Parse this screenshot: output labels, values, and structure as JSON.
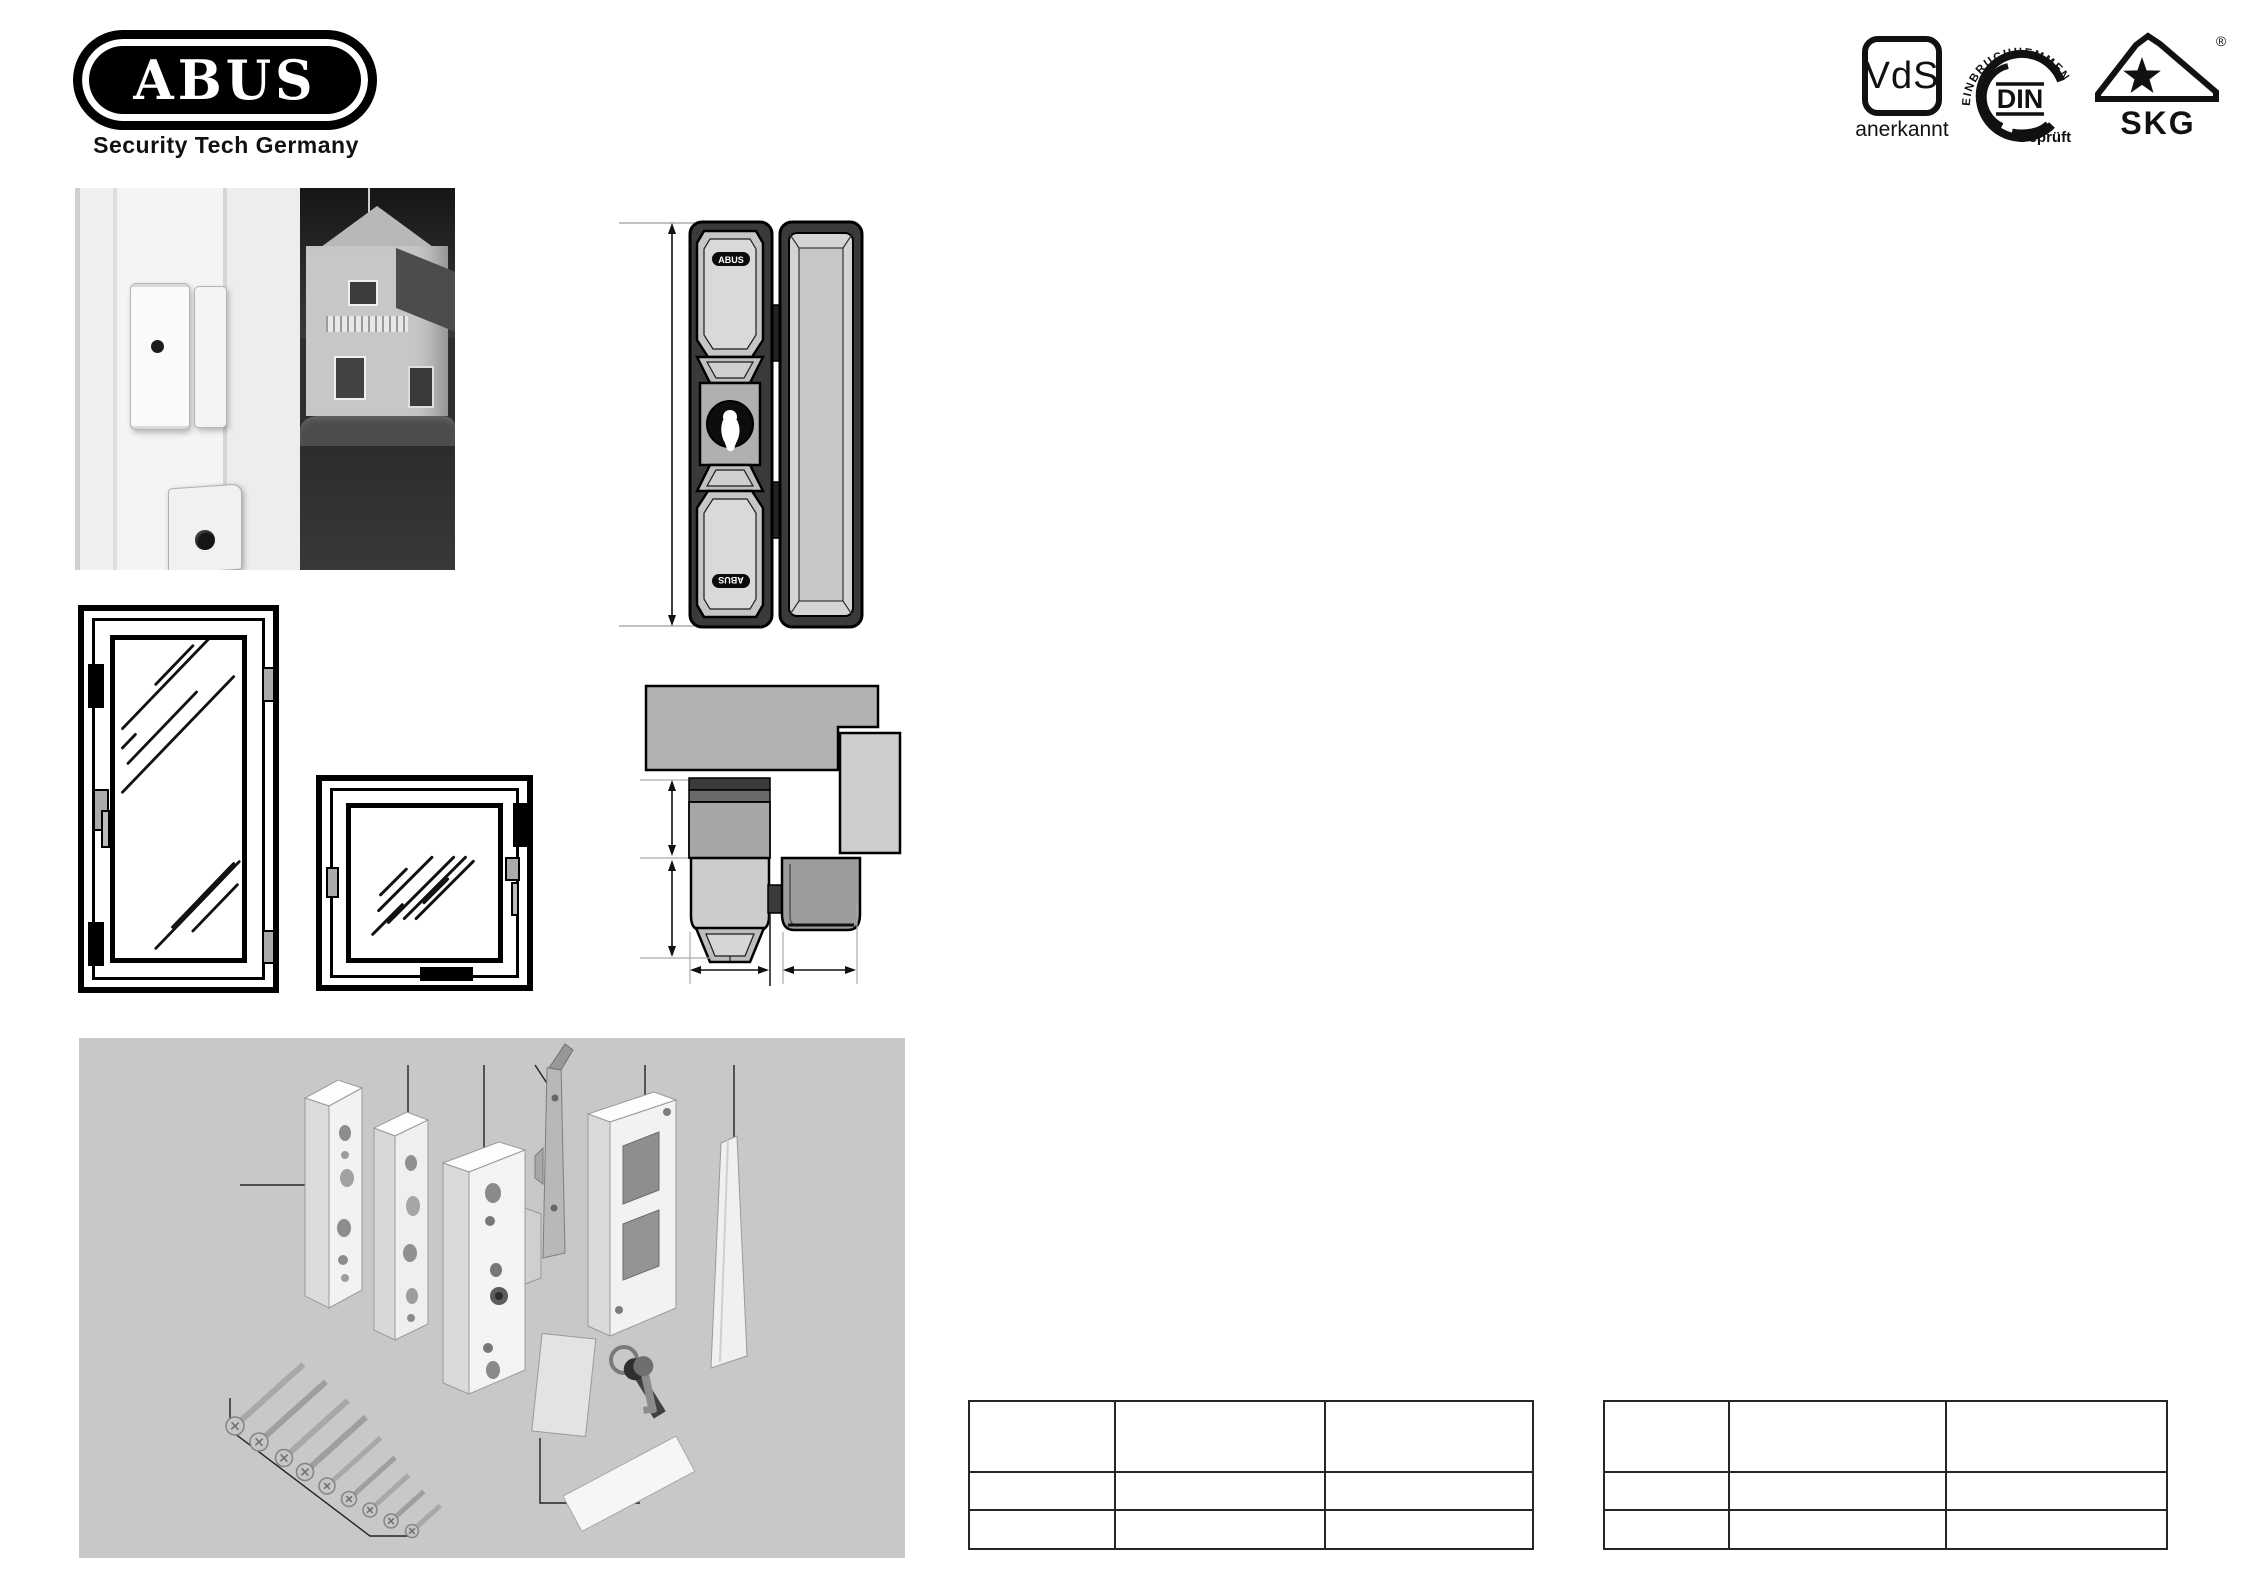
{
  "brand": {
    "logo_text": "ABUS",
    "tagline": "Security Tech Germany"
  },
  "certifications": {
    "vds": {
      "label": "VdS",
      "sublabel": "anerkannt"
    },
    "din": {
      "curved_text": "EINBRUCHHEMMEND",
      "label": "DIN",
      "sublabel": "Geprüft"
    },
    "skg": {
      "label": "SKG",
      "registered_mark": "®"
    }
  },
  "front_view": {
    "brand_badge_top": "ABUS",
    "brand_badge_bottom": "ABUS"
  },
  "tables": {
    "left": {
      "cells": [
        [
          "",
          "",
          ""
        ],
        [
          "",
          "",
          ""
        ],
        [
          "",
          "",
          ""
        ]
      ]
    },
    "right": {
      "cells": [
        [
          "",
          "",
          ""
        ],
        [
          "",
          "",
          ""
        ],
        [
          "",
          "",
          ""
        ]
      ]
    }
  },
  "colors": {
    "parts_box_background": "#c8c8c8",
    "drawing_dark": "#3a3a3a",
    "drawing_mid": "#a8a8a8",
    "drawing_light": "#d4d4d4",
    "frame_gray": "#b2b2b2",
    "frame_light_gray": "#cdcdcd"
  }
}
